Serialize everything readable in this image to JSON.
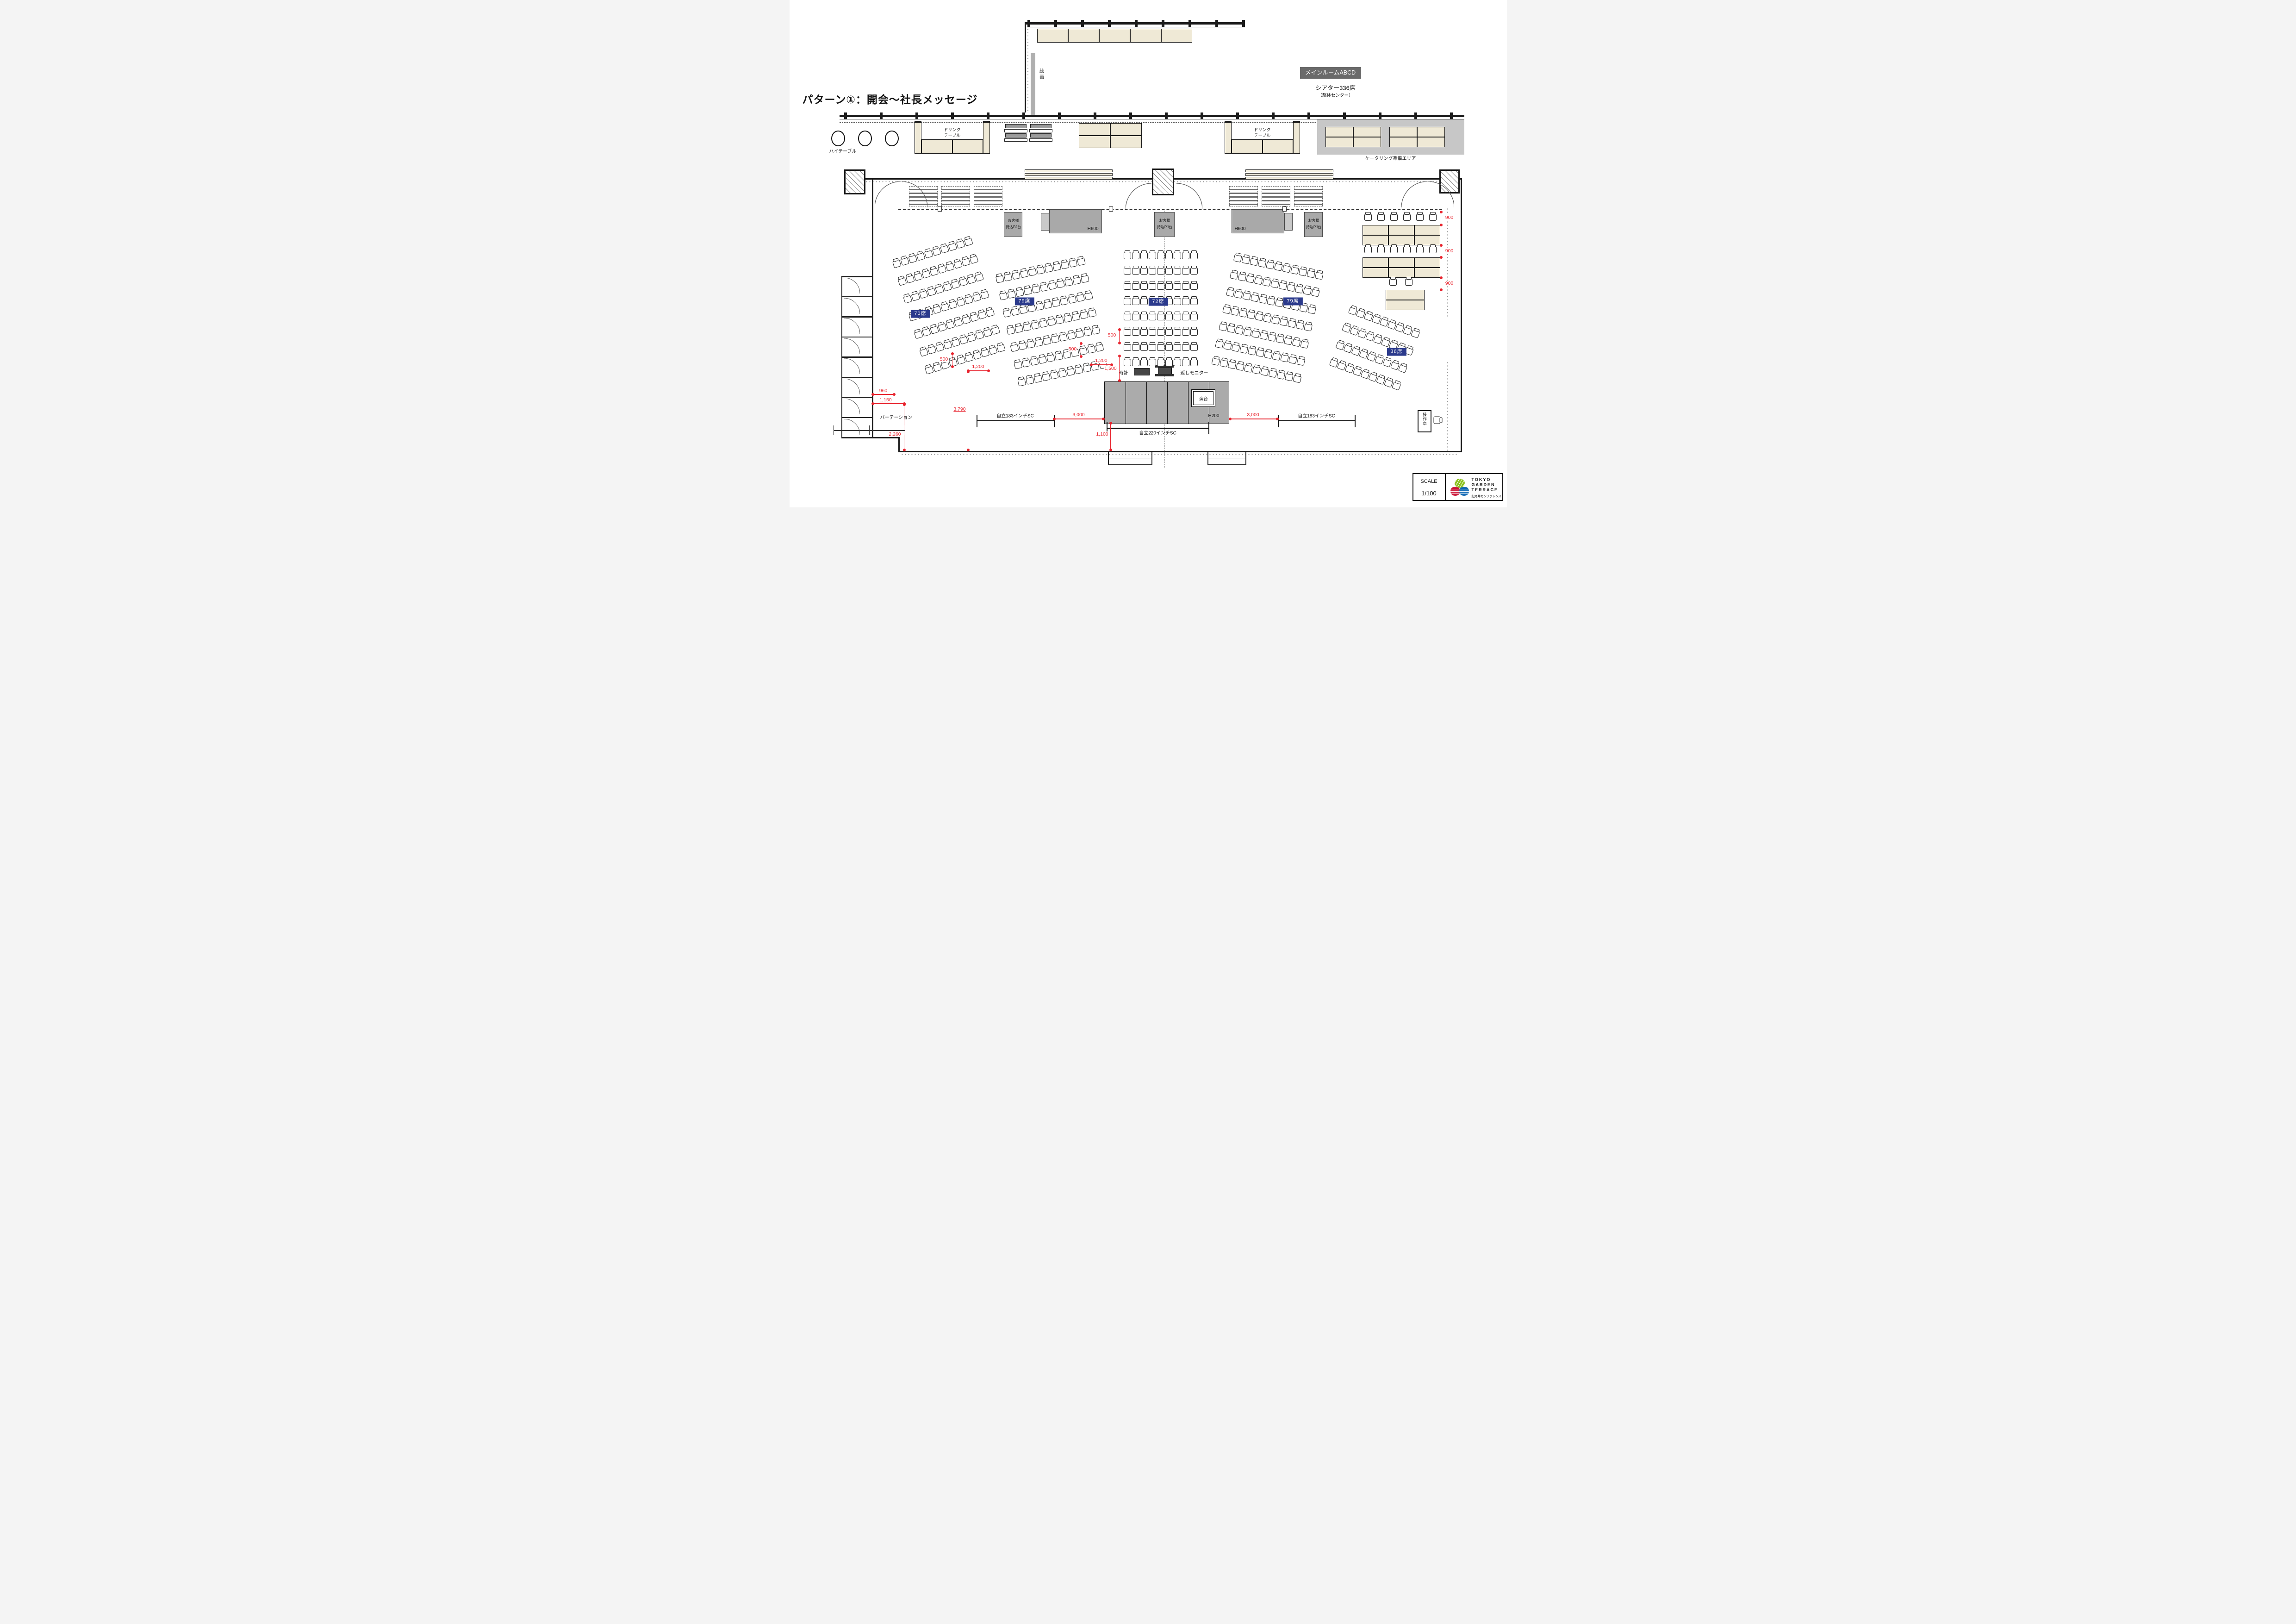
{
  "title": "パターン①：開会～社長メッセージ",
  "room_badge": {
    "label": "メインルームABCD",
    "bg": "#6A6A6A"
  },
  "capacity": {
    "seats": "シアター336席",
    "note": "（駆体センター）"
  },
  "foyer": {
    "high_table_label": "ハイテーブル",
    "drink_table_line1": "ドリンク",
    "drink_table_line2": "テーブル",
    "catering_label": "ケータリング準備エリア",
    "art_label": "絵画"
  },
  "room": {
    "pj_line1": "お客様",
    "pj_line2": "持込PJ台",
    "h600_label": "H600",
    "clock_label": "時計",
    "monitor_label": "返しモニター",
    "podium_label": "演台",
    "stage_height_label": "H200",
    "screen_side_label": "自立183インチSC",
    "screen_center_label": "自立220インチSC",
    "partition_label": "パーテーション",
    "console_label": "操作卓"
  },
  "seating": {
    "badge_bg": "#2B3A8C",
    "blocks": [
      {
        "badge": "70席",
        "rows": 7,
        "cols": 10
      },
      {
        "badge": "79席",
        "rows": 7,
        "cols": 11
      },
      {
        "badge": "72席",
        "rows": 8,
        "cols": 9
      },
      {
        "badge": "79席",
        "rows": 7,
        "cols": 11
      },
      {
        "badge": "36席",
        "rows": 4,
        "cols": 9
      }
    ]
  },
  "side_area": {
    "rows": [
      {
        "chairs": 6
      },
      {
        "chairs": 6
      },
      {
        "chairs": 2
      }
    ]
  },
  "dimensions": {
    "color": "#E8232D",
    "items": [
      "500",
      "1,200",
      "500",
      "1,200",
      "500",
      "1,500",
      "3,000",
      "3,000",
      "1,100",
      "960",
      "1,150",
      "3,790",
      "2,260",
      "900",
      "900",
      "900"
    ]
  },
  "scale_box": {
    "label": "SCALE",
    "value": "1/100"
  },
  "logo": {
    "name_line1": "TOKYO",
    "name_line2": "GARDEN",
    "name_line3": "TERRACE",
    "subtitle": "紀尾井カンファレンス",
    "green": "#8CC11F",
    "red": "#CE2343",
    "blue": "#1E71B8"
  }
}
